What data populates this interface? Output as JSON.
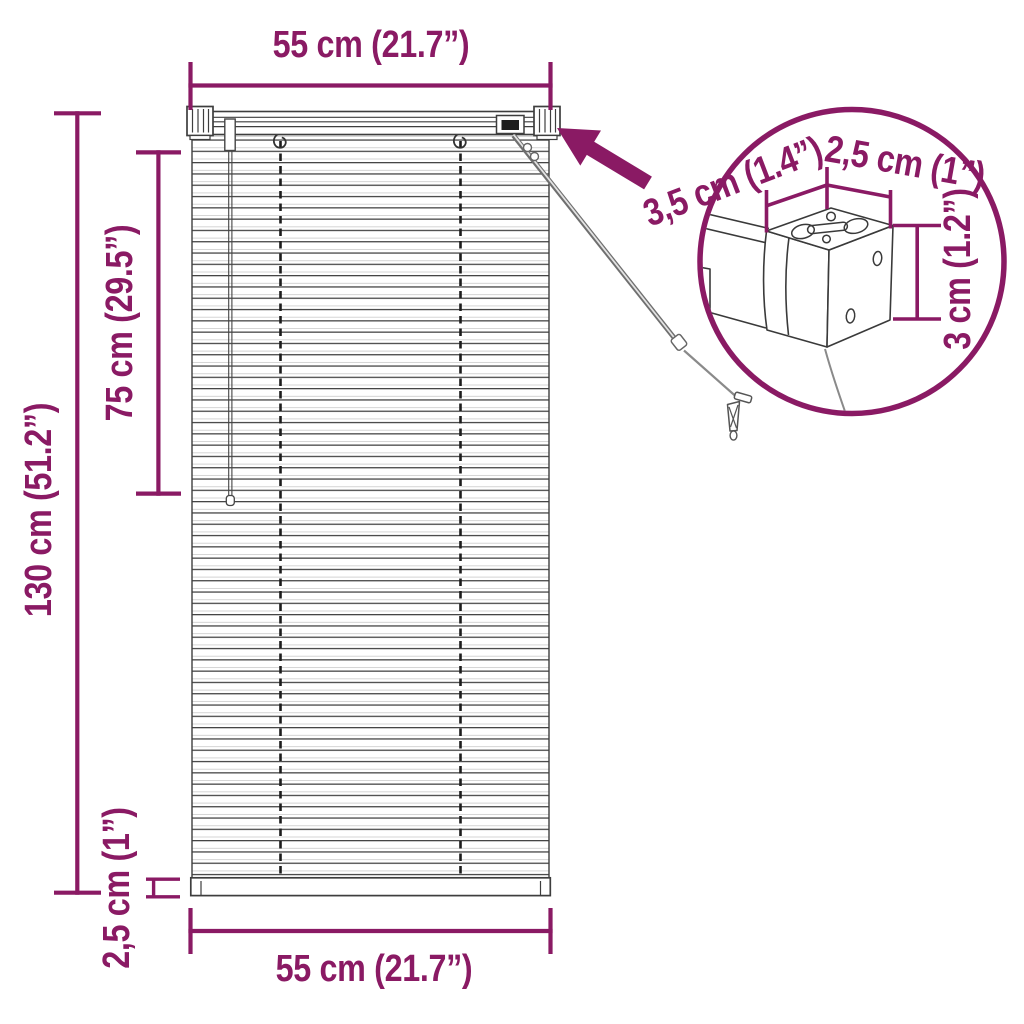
{
  "page": {
    "background": "#FFFFFF"
  },
  "colors": {
    "accent": "#8A1A64",
    "drawing_line": "#3E3E3E"
  },
  "dimensions": {
    "top_width": "55 cm (21.7”)",
    "bottom_width": "55 cm (21.7”)",
    "total_height": "130 cm (51.2”)",
    "upper_section_height": "75 cm (29.5”)",
    "bottom_rail_height": "2,5 cm (1”)",
    "bracket_depth": "3,5 cm (1.4”)",
    "bracket_width": "2,5 cm (1”)",
    "bracket_height": "3 cm (1.2”)"
  },
  "icons": {
    "callout_arrow": "solid-arrow-pointing-to-headrail-bracket"
  }
}
